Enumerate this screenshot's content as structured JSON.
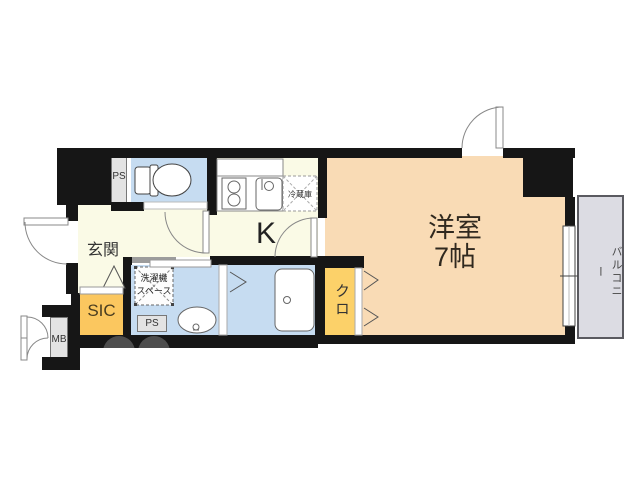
{
  "floorplan": {
    "rooms": {
      "living": {
        "name": "洋室",
        "size": "7帖"
      },
      "kitchen": {
        "label": "K"
      },
      "entrance": {
        "label": "玄関"
      },
      "shoe_closet": {
        "label": "SIC"
      },
      "closet": {
        "label": "クロ"
      },
      "balcony": {
        "label": "バルコニー"
      },
      "meter_box": {
        "label": "MB"
      },
      "pipe_space_top": {
        "label": "PS"
      },
      "pipe_space_bottom": {
        "label": "PS"
      },
      "laundry_space": {
        "line1": "洗濯機",
        "line2": "スペース"
      },
      "refrigerator": {
        "label": "冷蔵庫"
      }
    },
    "colors": {
      "room_peach": "#f9dbb5",
      "room_yellow": "#fbc75f",
      "room_yellow2": "#fcd169",
      "room_blue": "#c6dcf1",
      "floor_cream": "#fafae6",
      "balcony_gray": "#dcdce3",
      "wall_black": "#161616",
      "box_gray": "#e3e3e3"
    }
  }
}
